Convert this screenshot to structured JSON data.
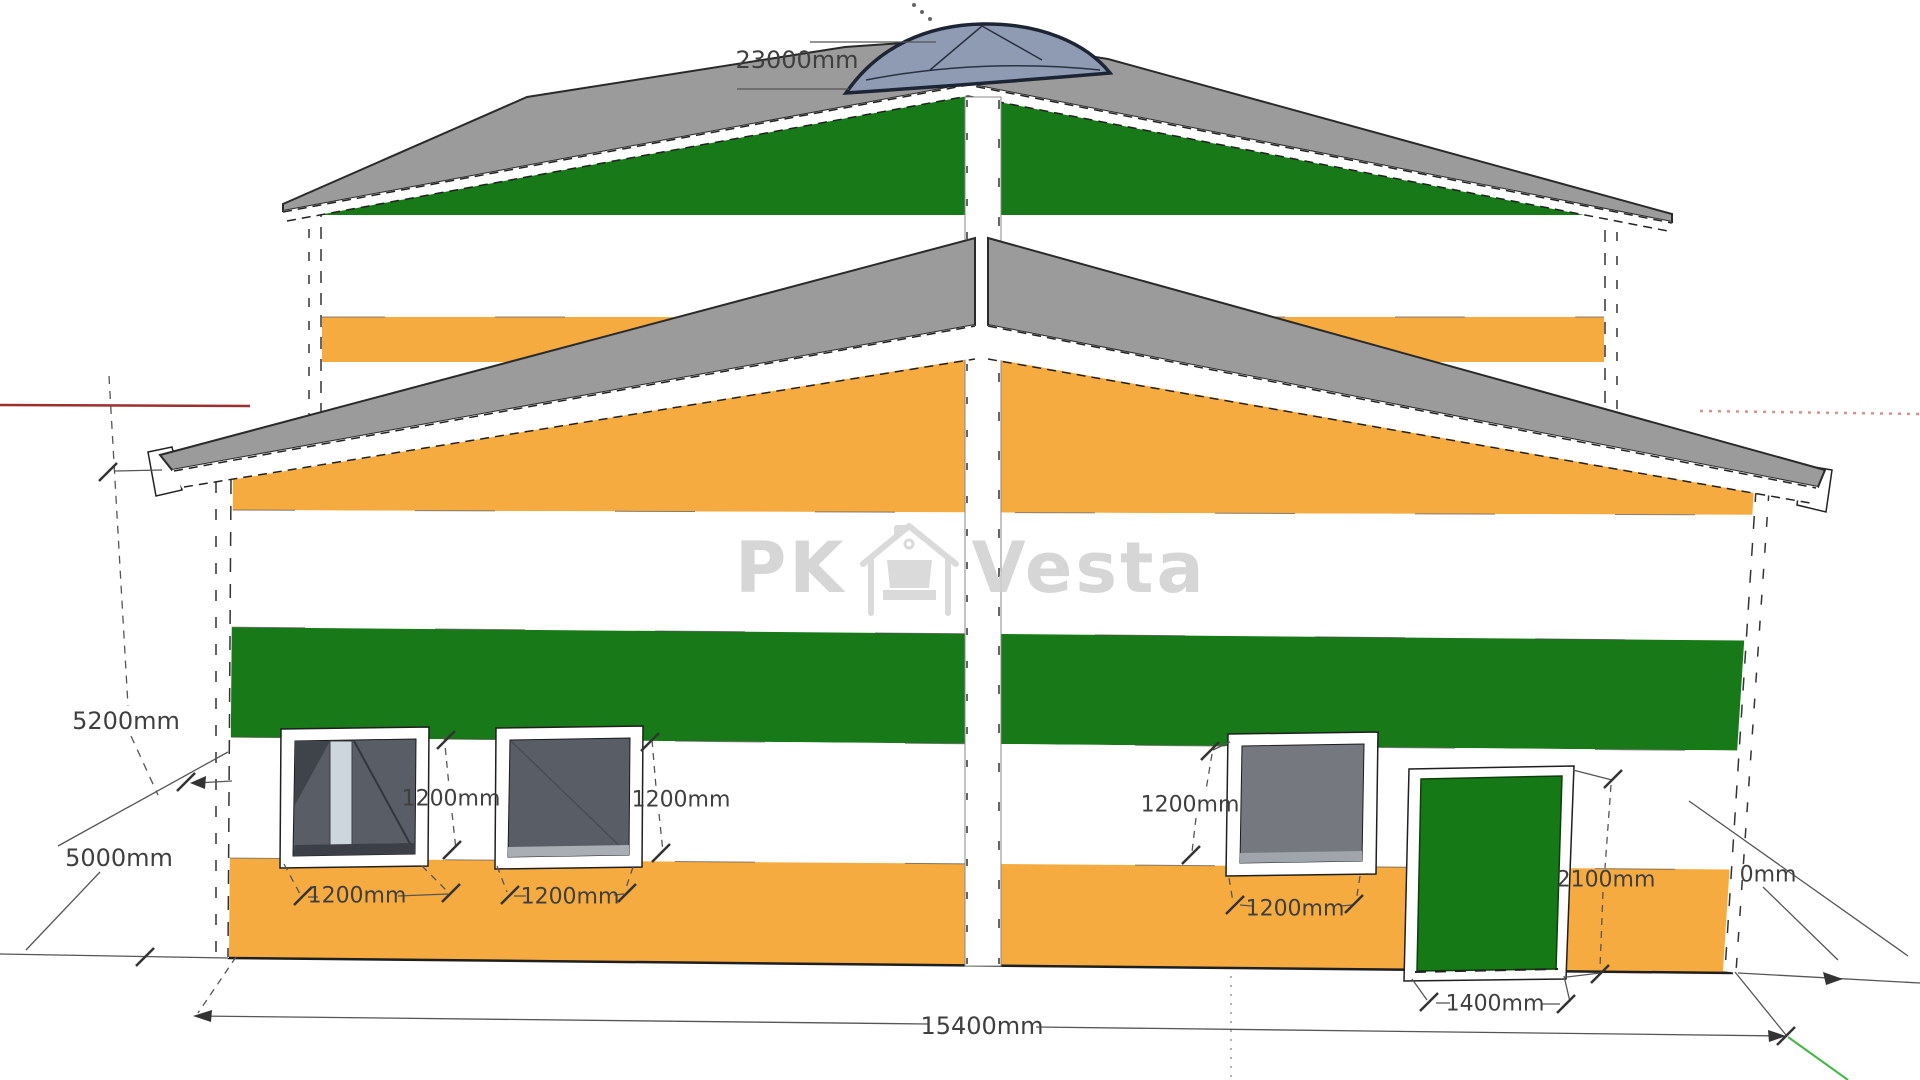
{
  "watermark": {
    "prefix": "PK",
    "suffix": "Vesta",
    "icon": "house-with-sofa"
  },
  "dimensions": {
    "ridge_width": "23000mm",
    "upper_floor_height": "5200mm",
    "lower_floor_height": "5000mm",
    "window1_height": "1200mm",
    "window1_width": "1200mm",
    "window2_height": "1200mm",
    "window2_width": "1200mm",
    "window3_height": "1200mm",
    "window3_width": "1200mm",
    "door_height": "2100mm",
    "door_width": "1400mm",
    "total_width": "15400mm",
    "right_edge_clipped": "0mm"
  },
  "colors": {
    "wall_green": "#177917",
    "wall_orange": "#f6ab41",
    "roof_gray": "#9b9b9b",
    "skylight_blue": "#8e9bb2",
    "skylight_outline": "#1d2534",
    "door_green": "#157a15",
    "pane_dark": "#585d66",
    "pane_medium": "#75797f",
    "pane_light": "#cdd6dd",
    "frame_white": "#ffffff",
    "axis_red": "#9e2f2f",
    "axis_red_dotted": "#d89090",
    "axis_green": "#43b843",
    "dim_text": "#3f3f3f",
    "watermark_gray": "#d0d0d0",
    "outline_dark": "#1f1f1f"
  }
}
